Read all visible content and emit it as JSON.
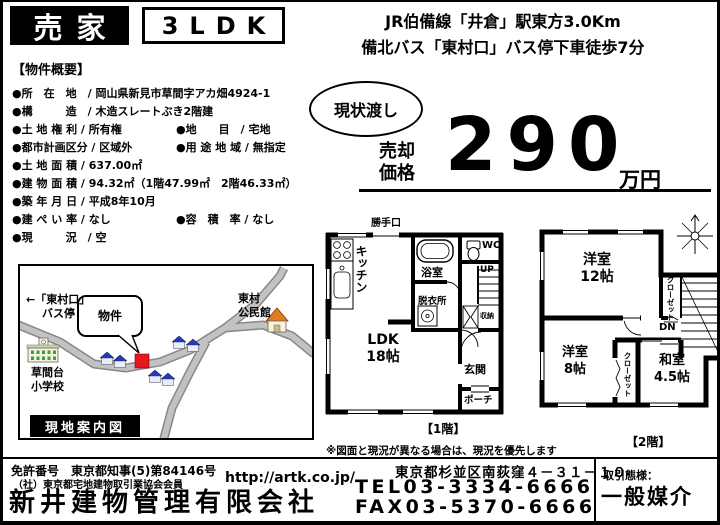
{
  "header": {
    "sale_tag": "売家",
    "layout": "3LDK",
    "access_line1": "JR伯備線「井倉」駅東方3.0Km",
    "access_line2": "備北バス「東村口」バス停下車徒歩7分"
  },
  "overview": {
    "title": "【物件概要】",
    "rows": [
      {
        "left": "●所　在　地　/ 岡山県新見市草間字アカ畑4924-1",
        "right": ""
      },
      {
        "left": "●構　　　造　/ 木造スレートぶき2階建",
        "right": ""
      },
      {
        "left": "●土 地 権 利 / 所有権",
        "right": "●地　　目　/ 宅地"
      },
      {
        "left": "●都市計画区分 / 区域外",
        "right": "●用 途 地 域 / 無指定"
      },
      {
        "left": "●土 地 面 積 / 637.00㎡",
        "right": ""
      },
      {
        "left": "●建 物 面 積 / 94.32㎡（1階47.99㎡　2階46.33㎡）",
        "right": ""
      },
      {
        "left": "●築 年 月 日 / 平成8年10月",
        "right": ""
      },
      {
        "left": "●建 ぺ い 率 / なし",
        "right": "●容　積　率 / なし"
      },
      {
        "left": "●現　　　況　/ 空",
        "right": ""
      }
    ]
  },
  "price": {
    "badge": "現状渡し",
    "label_line1": "売却",
    "label_line2": "価格",
    "value": "290",
    "unit": "万円"
  },
  "floorplan": {
    "note": "※図面と現況が異なる場合は、現況を優先します",
    "f1": {
      "caption": "【1階】",
      "labels": {
        "back_door": "勝手口",
        "kitchen": "キッチン",
        "bath": "浴室",
        "wc": "WC",
        "up": "UP",
        "dressing": "脱衣所",
        "storage": "収納",
        "ldk_line1": "LDK",
        "ldk_line2": "18帖",
        "entrance": "玄関",
        "porch": "ポーチ"
      }
    },
    "f2": {
      "caption": "【2階】",
      "labels": {
        "room12_line1": "洋室",
        "room12_line2": "12帖",
        "closet_a": "クローゼット",
        "dn": "DN",
        "room8_line1": "洋室",
        "room8_line2": "8帖",
        "closet_b": "クローゼット",
        "washitsu_line1": "和室",
        "washitsu_line2": "4.5帖"
      }
    }
  },
  "map": {
    "caption": "現地案内図",
    "bus_stop_line1": "←「東村口」",
    "bus_stop_line2": "バス停",
    "property_callout": "物件",
    "community_center_line1": "東村",
    "community_center_line2": "公民館",
    "school_line1": "草間台",
    "school_line2": "小学校",
    "marker_color": "#e8161d"
  },
  "footer": {
    "license_no": "免許番号　東京都知事(5)第84146号",
    "membership": "（社）東京都宅地建物取引業協会会員",
    "url": "http://artk.co.jp/",
    "company": "新井建物管理有限会社",
    "address": "東京都杉並区南荻窪４－３１－１０",
    "tel": "TEL03-3334-6666",
    "fax": "FAX03-5370-6666",
    "dealing_label": "取引態様：",
    "dealing_value": "一般媒介"
  }
}
